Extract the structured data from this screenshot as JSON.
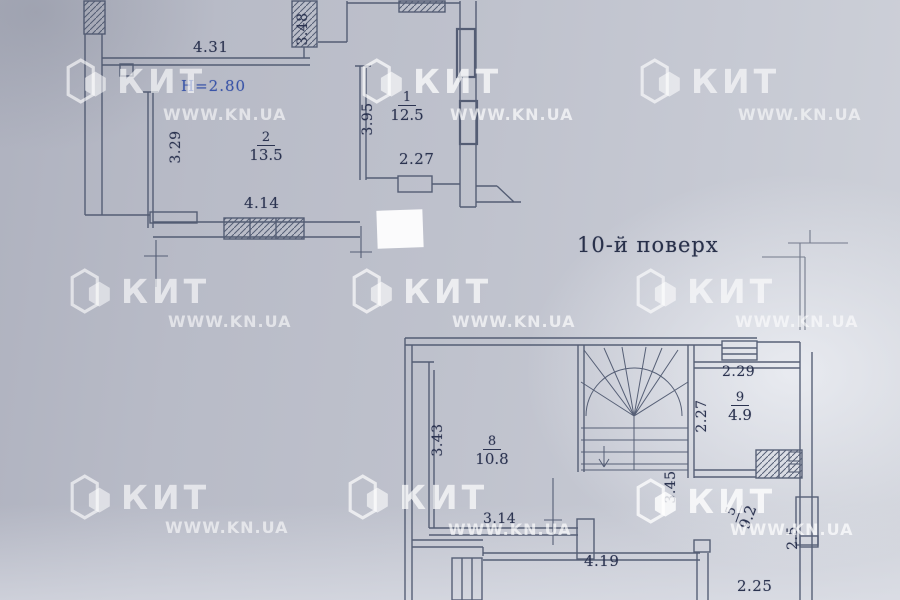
{
  "floor_title": "10-й поверх",
  "watermark": {
    "brand": "КИТ",
    "url": "WWW.KN.UA"
  },
  "colors": {
    "paper": "#bec1cc",
    "line": "#49536b",
    "text": "#2b3350",
    "height_note": "#3a55a8",
    "watermark": "#ffffff"
  },
  "upper_plan": {
    "height_note": "H=2.80",
    "dim_top": "4.31",
    "dim_right_top": "3.48",
    "dim_left": "3.29",
    "dim_bottom": "4.14",
    "room2_number": "2",
    "room2_area": "13.5",
    "room1_number": "1",
    "room1_area": "12.5",
    "dim_r1_left": "3.95",
    "dim_r1_width": "2.27"
  },
  "lower_plan": {
    "dim_room9_top": "2.29",
    "room9_number": "9",
    "room9_area": "4.9",
    "dim_room9_left": "2.27",
    "dim_room8_left": "3.43",
    "room8_number": "8",
    "room8_area": "10.8",
    "dim_room8_bottom": "3.14",
    "dim_stair_side": "3.45",
    "room5_number": "5",
    "room5_area": "9.2",
    "dim_right": "2.5",
    "dim_bottom": "4.19",
    "dim_bottom_right": "2.25"
  }
}
